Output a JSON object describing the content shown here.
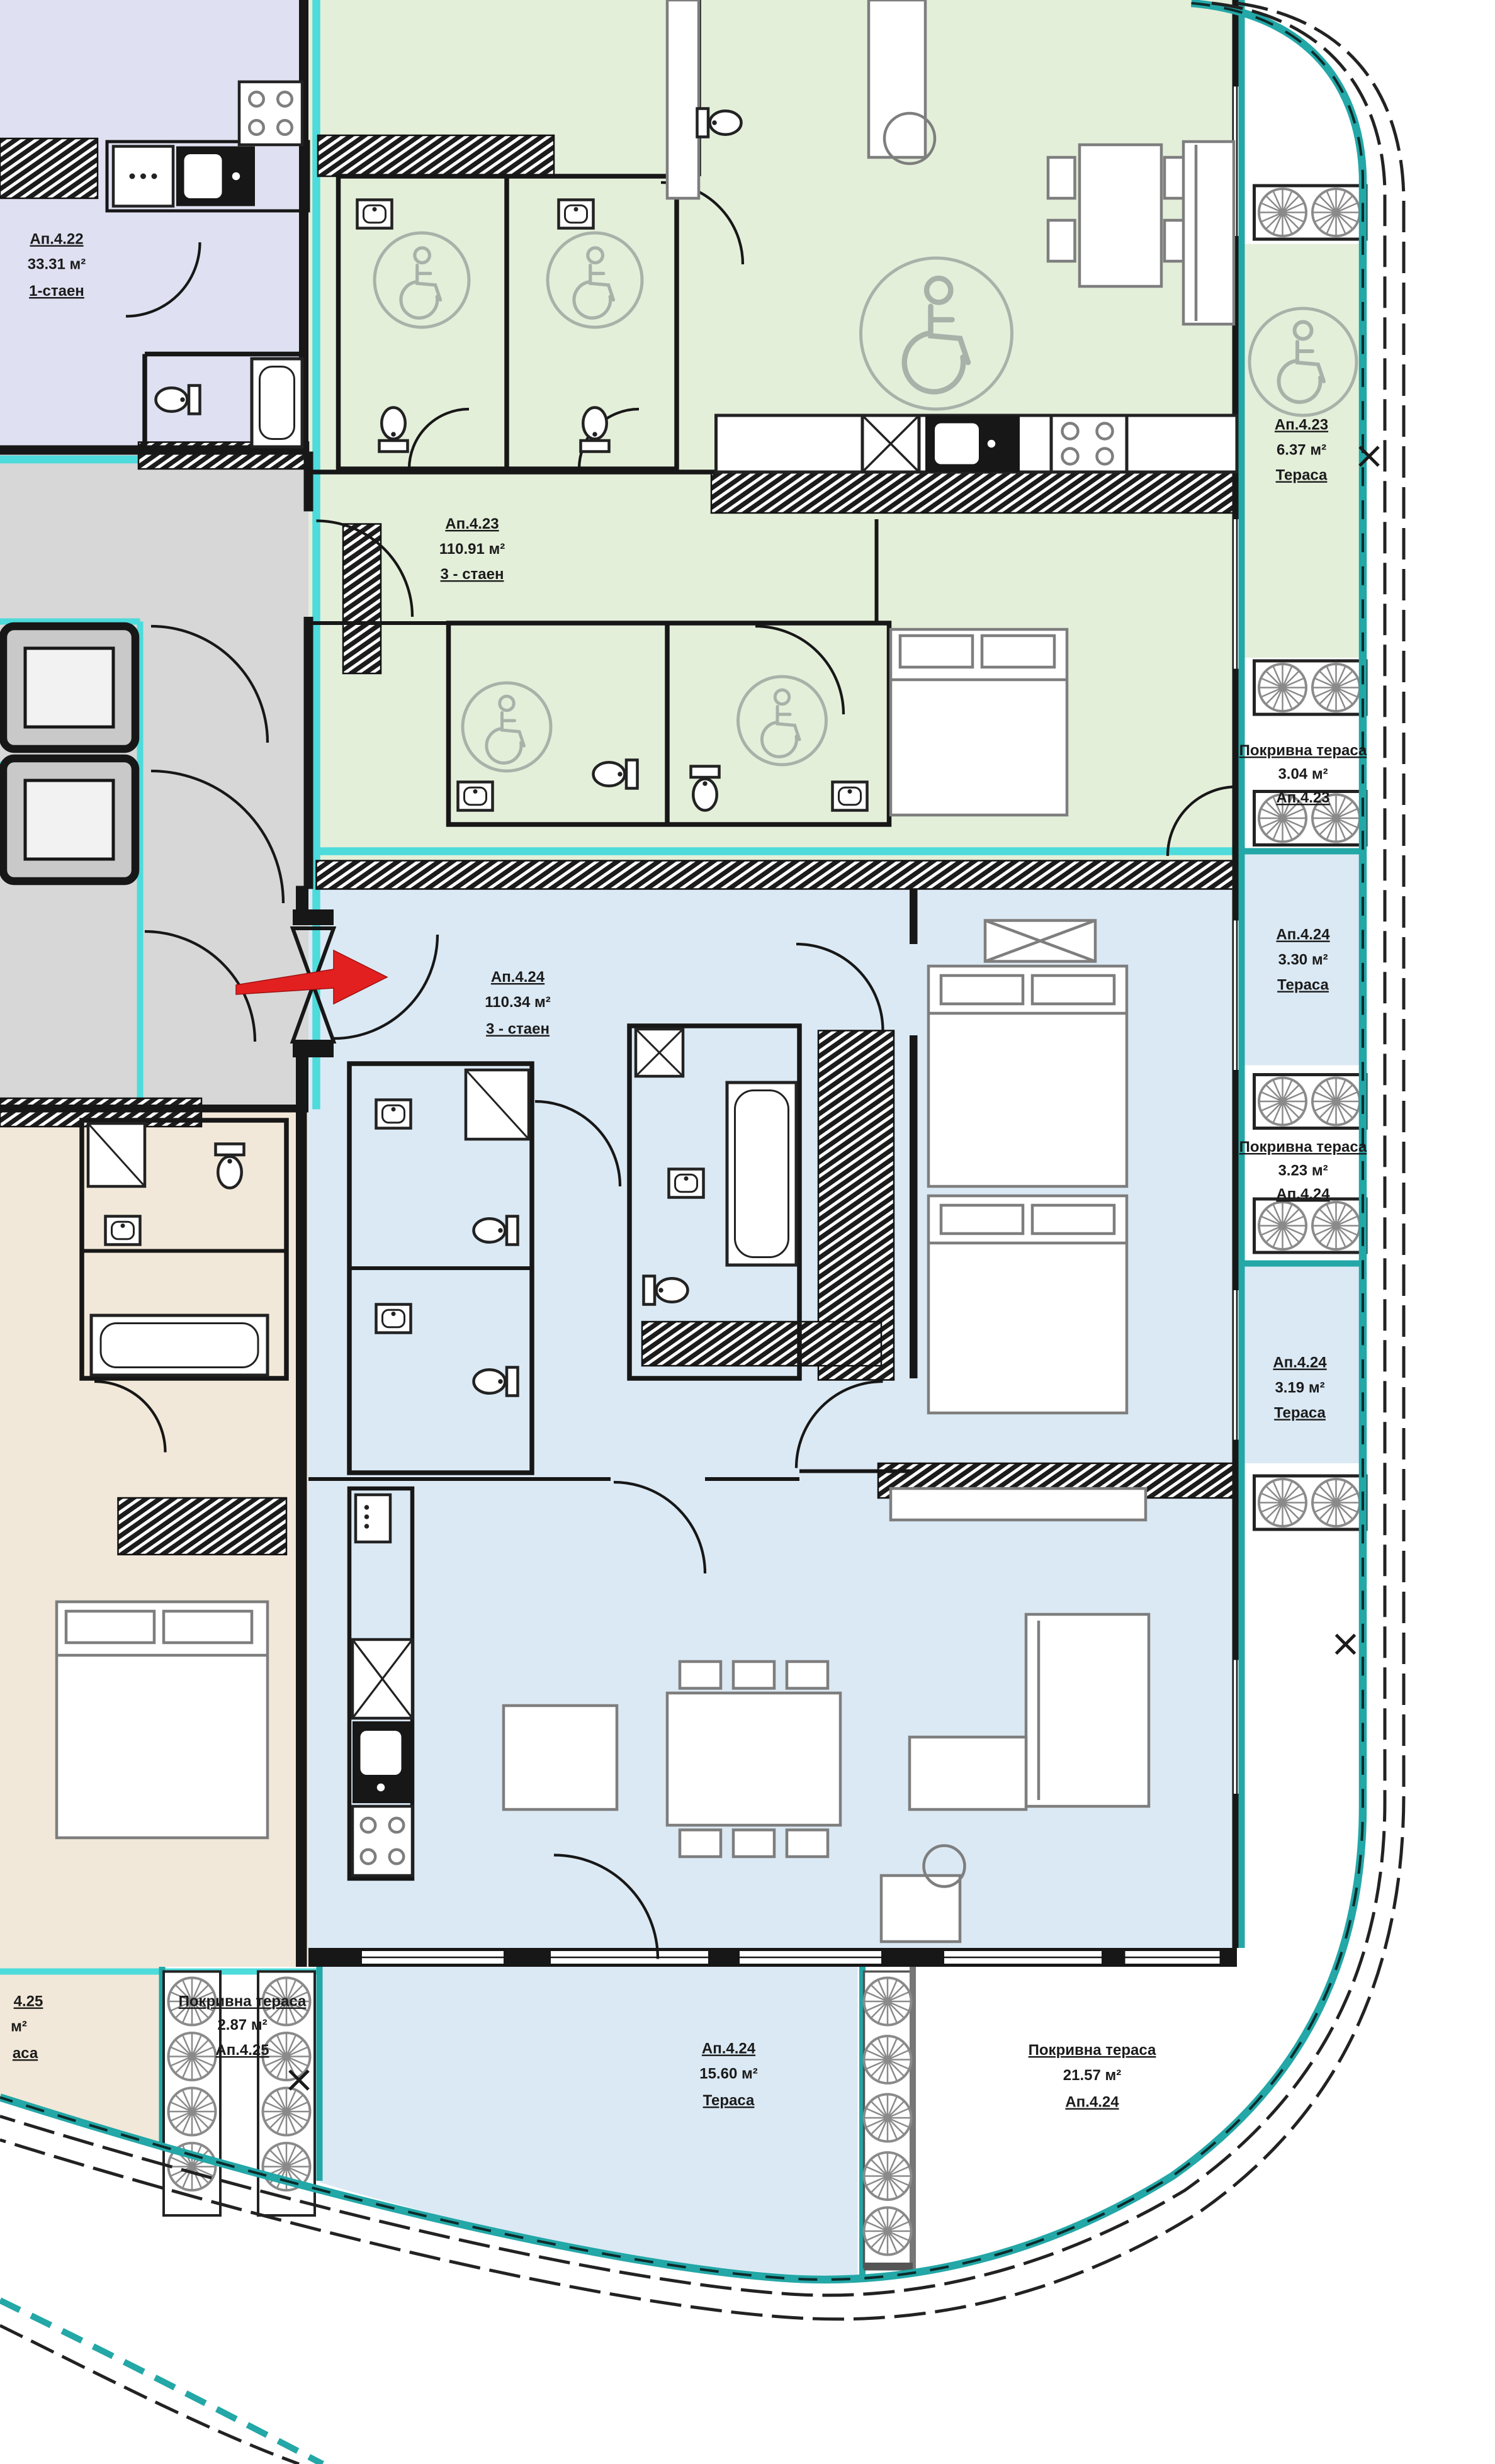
{
  "colors": {
    "lavender": "#dfe1f2",
    "green": "#e4efda",
    "blue": "#dbe9f4",
    "beige": "#f2e8d9",
    "gray": "#d7d7d7",
    "teal": "#23a7a7",
    "aqua": "#4ddbdb",
    "wall": "#171717",
    "furn": "#7e7e7e",
    "access": "#a9b2a9",
    "red": "#e32020",
    "ink": "#1b1b1b"
  },
  "labels": {
    "apt422": {
      "id": "Ап.4.22",
      "area": "33.31 м²",
      "type": "1-стаен"
    },
    "apt423": {
      "id": "Ап.4.23",
      "area": "110.91 м²",
      "type": "3 - стаен"
    },
    "apt424": {
      "id": "Ап.4.24",
      "area": "110.34 м²",
      "type": "3 - стаен"
    },
    "t423": {
      "id": "Ап.4.23",
      "area": "6.37 м²",
      "kind": "Тераса"
    },
    "roof423": {
      "kind": "Покривна тераса",
      "area": "3.04 м²",
      "id": "Ап.4.23"
    },
    "t424a": {
      "id": "Ап.4.24",
      "area": "3.30 м²",
      "kind": "Тераса"
    },
    "roof424a": {
      "kind": "Покривна тераса",
      "area": "3.23 м²",
      "id": "Ап.4.24"
    },
    "t424b": {
      "id": "Ап.4.24",
      "area": "3.19 м²",
      "kind": "Тераса"
    },
    "t424main": {
      "id": "Ап.4.24",
      "area": "15.60 м²",
      "kind": "Тераса"
    },
    "roof424main": {
      "kind": "Покривна тераса",
      "area": "21.57 м²",
      "id": "Ап.4.24"
    },
    "roof425": {
      "kind": "Покривна тераса",
      "area": "2.87 м²",
      "id": "Ап.4.25"
    },
    "apt425cut": {
      "id": "4.25",
      "area": "м²",
      "kind": "аса"
    }
  }
}
